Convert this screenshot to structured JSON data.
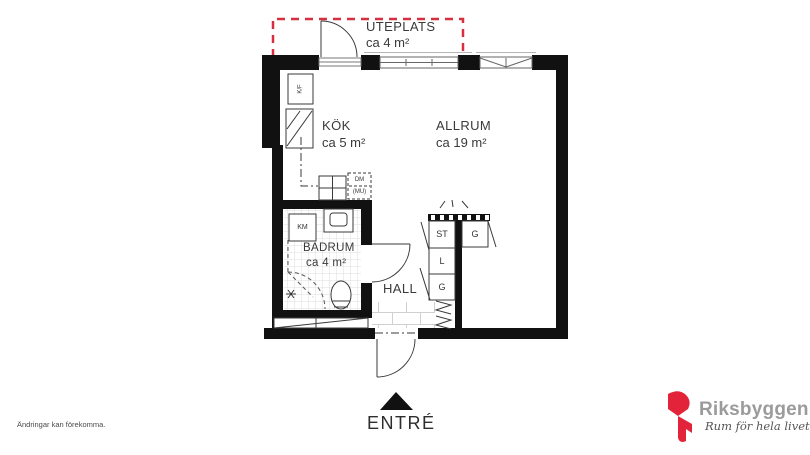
{
  "plan": {
    "labels": {
      "uteplats": "UTEPLATS",
      "uteplats_area": "ca 4 m²",
      "kok": "KÖK",
      "kok_area": "ca 5 m²",
      "allrum": "ALLRUM",
      "allrum_area": "ca 19 m²",
      "badrum": "BADRUM",
      "badrum_area": "ca 4 m²",
      "hall": "HALL",
      "entre": "ENTRÉ",
      "closet_st": "ST",
      "closet_l": "L",
      "closet_g_left": "G",
      "closet_g_right": "G",
      "fridge_freezer": "K/F",
      "washing_machine": "KM",
      "dishwasher": "DM",
      "dishwasher_note": "(MU)"
    },
    "colors": {
      "wall": "#111111",
      "line": "#3a3a3a",
      "outdoor_boundary_red": "#d63040",
      "tile_line": "#d9d9d9"
    }
  },
  "footer": {
    "disclaimer": "Ändringar kan förekomma."
  },
  "logo": {
    "name": "Riksbyggen",
    "tagline": "Rum för hela livet",
    "brand_red": "#e2233a",
    "brand_gray": "#9b9b9b"
  }
}
